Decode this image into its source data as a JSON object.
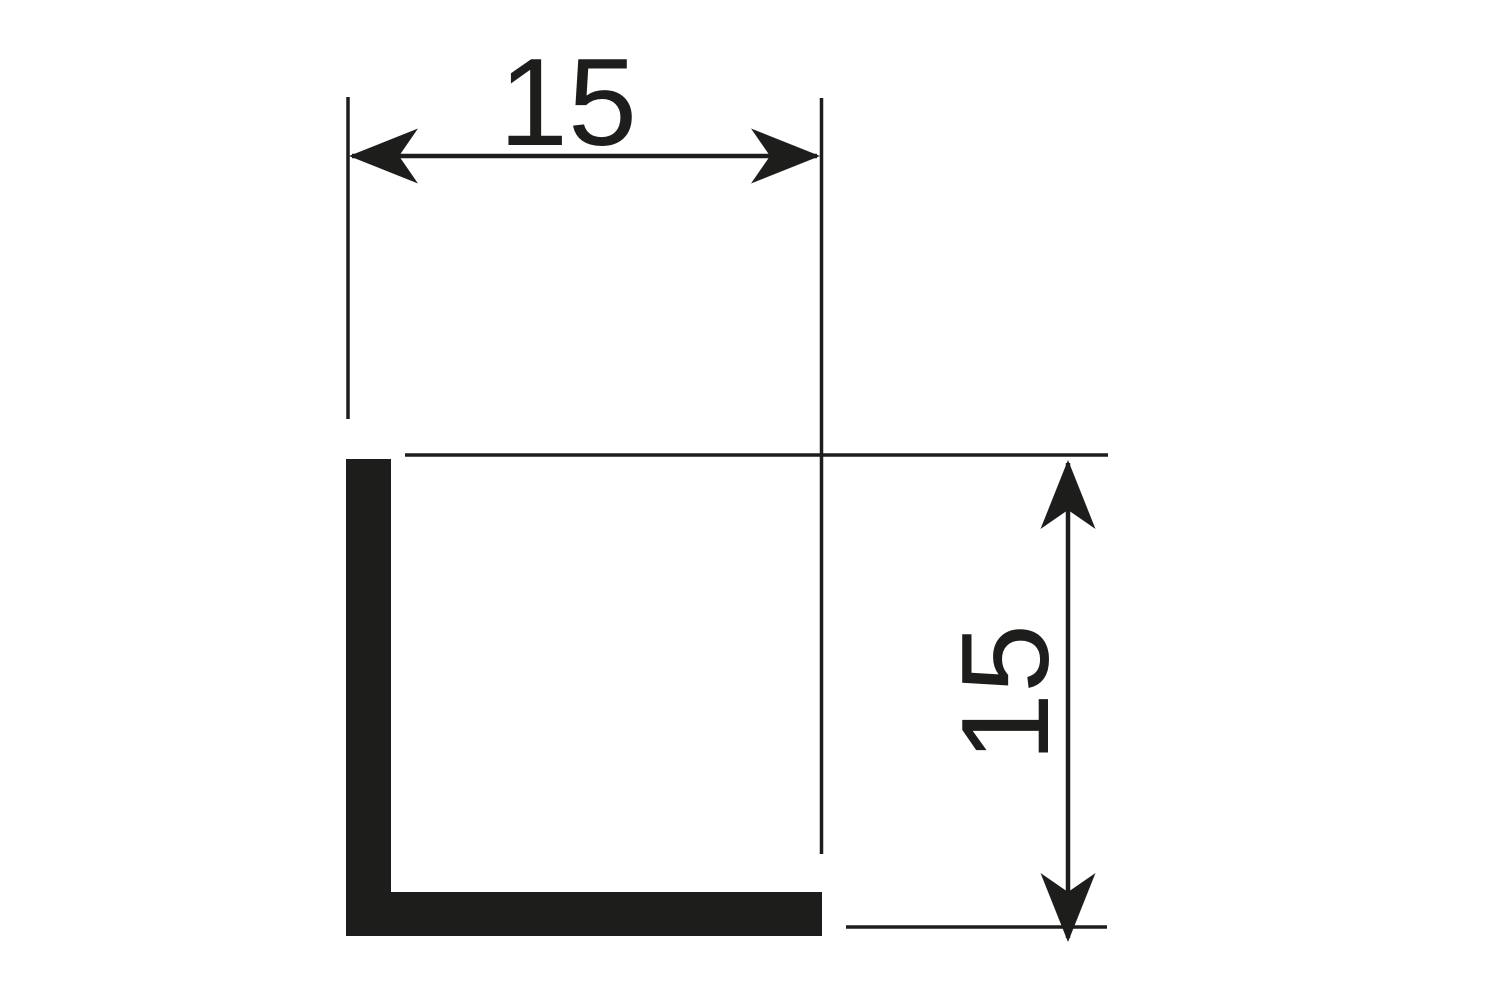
{
  "drawing": {
    "width_dimension_label": "15",
    "height_dimension_label": "15"
  },
  "colors": {
    "ink": "#1d1d1b",
    "background": "#ffffff"
  }
}
